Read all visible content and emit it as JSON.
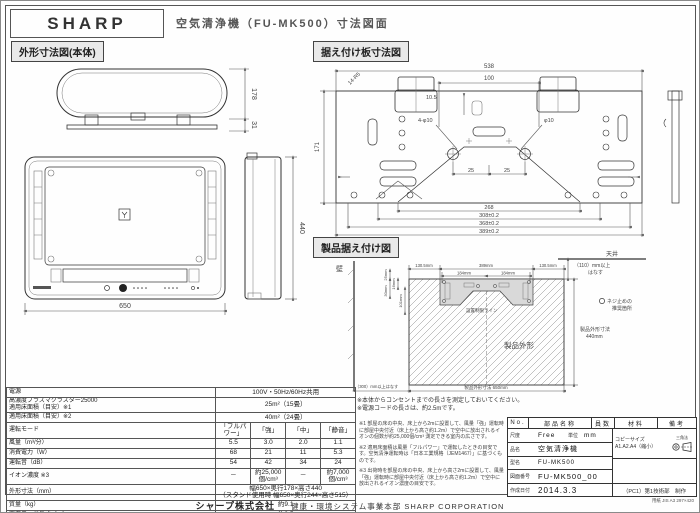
{
  "header": {
    "brand": "SHARP",
    "title": "空気清浄機（FU-MK500）寸法図面"
  },
  "sections": {
    "outline": "外形寸法図(本体)",
    "plate": "据え付け板寸法図",
    "install": "製品据え付け図"
  },
  "outline": {
    "depth": "178",
    "foot": "31",
    "width": "650",
    "height": "440"
  },
  "plate": {
    "top": "538",
    "center": "100",
    "left": "171",
    "corner": "14-R5",
    "edge": "10.5",
    "hole": "4-φ10",
    "hole2": "φ10",
    "p1": "25",
    "p2": "25",
    "b1": "268",
    "b2": "308±0.2",
    "b3": "368±0.2",
    "b4": "389±0.2"
  },
  "install": {
    "wall": "壁",
    "ceiling": "天井",
    "gap_top1": "（110）mm以上",
    "gap_top2": "はなす",
    "d_left": "130.5mm",
    "d_mid": "389mm",
    "d_right": "130.5mm",
    "p_left": "184mm",
    "p_right": "184mm",
    "v1": "25mm",
    "v2": "16mm",
    "v3": "30mm",
    "v4": "101mm",
    "limit": "設置制限ライン",
    "outline_label": "製品外形",
    "h_label": "製品外形寸法",
    "h_value": "440mm",
    "screw1": "ネジ止めの",
    "screw2": "推奨箇所",
    "gap_left": "（300）mm以上はなす",
    "w_label": "製品外形寸法 650mm",
    "note1": "※本体からコンセントまでの長さを測定しておいてください。",
    "note2": "※電源コードの長さは、約2.5mです。"
  },
  "spec": {
    "rows": [
      {
        "label": "電源",
        "span": "100V・50Hz/60Hz共用"
      },
      {
        "label": "高濃度プラズマクラスター25000\n適用床面積（目安）※1",
        "span": "25m²（15畳）"
      },
      {
        "label": "適用床面積（目安）※2",
        "span": "40m²（24畳）"
      },
      {
        "label": "運転モード",
        "cols": [
          "「フルパワー」",
          "「強」",
          "「中」",
          "「静音」"
        ]
      },
      {
        "label": "風量（m³/分）",
        "cols": [
          "5.5",
          "3.0",
          "2.0",
          "1.1"
        ]
      },
      {
        "label": "消費電力（W）",
        "cols": [
          "68",
          "21",
          "11",
          "5.3"
        ]
      },
      {
        "label": "運転音（dB）",
        "cols": [
          "54",
          "42",
          "34",
          "24"
        ]
      },
      {
        "label": "イオン濃度 ※3",
        "cols": [
          "－",
          "約25,000個/cm³",
          "－",
          "約7,000個/cm³"
        ]
      },
      {
        "label": "外形寸法（mm）",
        "span": "幅650×奥行178×高さ440\n（スタンド使用時 幅650×奥行244×高さ515）"
      },
      {
        "label": "質量（kg）",
        "span": "約9.1"
      },
      {
        "label": "電源コード長さ（m）",
        "span": "約2.5"
      }
    ]
  },
  "notes": [
    "※1 部屋の床の中央、床上から2mに設置して、風量「強」運転時に部屋中央付近（床上から高さ約1.2m）で空中に放出されるイオンの個数が約25,000個/cm³ 測定できる室内の広さです。",
    "※2 適用床面積は風量「フルパワー」で運転したときの目安です。空気清浄運転時は「日本工業規格（JEM1467）」に基づくものです。",
    "※3 出荷時を部屋の床の中央、床上から高さ2mに設置して、風量「強」運転時に部屋中央付近（床上から高さ約1.2m）で空中に放出されるイオン濃度の目安です。"
  ],
  "title_block": {
    "headers": [
      "No.",
      "部品名称",
      "員数",
      "材料",
      "備考"
    ],
    "scale_label": "尺度",
    "scale_value": "Free",
    "unit_label": "単位",
    "unit_value": "mm",
    "copy_label": "コピーサイズ",
    "copy_value": "A1.A2.A4（縮小）",
    "projection": "三角法",
    "name_label": "品名",
    "name_value": "空気清浄機",
    "model_label": "型名",
    "model_value": "FU-MK500",
    "dwg_label": "図面番号",
    "dwg_value": "FU-MK500_00",
    "date_label": "作成日付",
    "date_value": "2014.3.3",
    "dept": "（PC1）第1技術部　制作"
  },
  "footer": {
    "company": "シャープ株式会社",
    "division": "健康・環境システム事業本部 SHARP CORPORATION",
    "paper": "用紙 JIS A3 297×420"
  }
}
